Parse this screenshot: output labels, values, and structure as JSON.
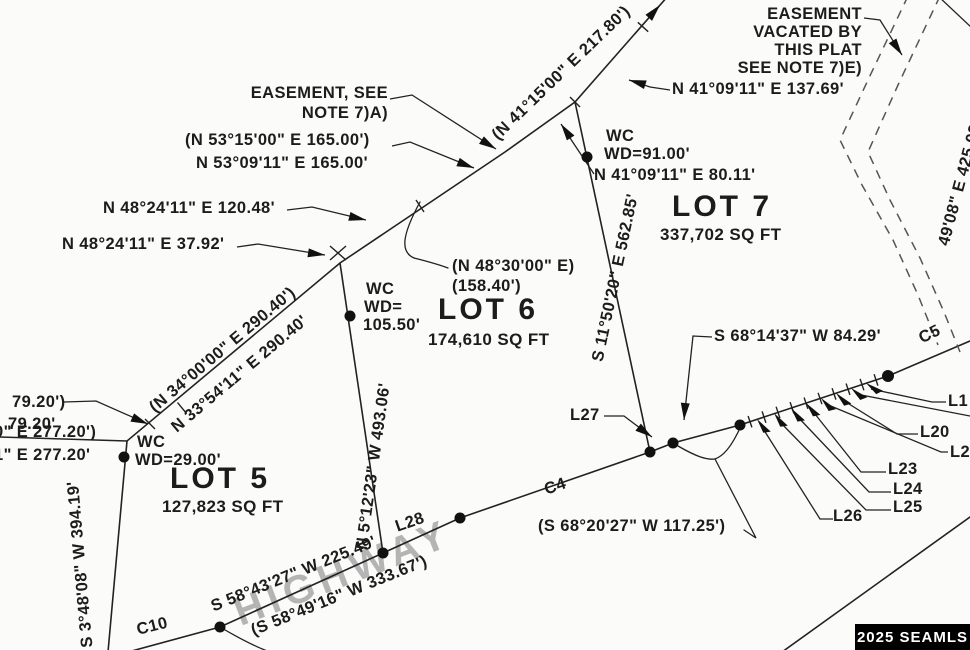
{
  "colors": {
    "ink": "#222222",
    "dash": "#555555",
    "watermark": "#b4b4b4",
    "badge_bg": "#000000",
    "badge_text": "#ffffff"
  },
  "labels": {
    "easement_a_1": "EASEMENT, SEE",
    "easement_a_2": "NOTE 7)A)",
    "easement_e_1": "EASEMENT",
    "easement_e_2": "VACATED BY",
    "easement_e_3": "THIS PLAT",
    "easement_e_4": "SEE NOTE 7)E)",
    "b_n5315": "(N 53°15'00\" E  165.00')",
    "b_n5309": "N 53°09'11\" E  165.00'",
    "b_n4824_120": "N 48°24'11\" E  120.48'",
    "b_n4824_37": "N 48°24'11\" E  37.92'",
    "b_n4115": "(N 41°15'00\" E  217.80')",
    "b_n4109_137": "N 41°09'11\" E  137.69'",
    "b_n4109_80": "N 41°09'11\" E  80.11'",
    "wc1": "WC",
    "wc1_wd": "WD=91.00'",
    "b_n3400": "(N 34°00'00\" E  290.40')",
    "b_n3354": "N 33°54'11\" E  290.40'",
    "b_n4830": "(N 48°30'00\" E)",
    "b_n4830_d": "(158.40')",
    "wc2": "WC",
    "wc2_wd": "WD=",
    "wc2_wd2": "105.50'",
    "lot5": "LOT 5",
    "lot5_area": "127,823 SQ FT",
    "lot6": "LOT 6",
    "lot6_area": "174,610 SQ FT",
    "lot7": "LOT 7",
    "lot7_area": "337,702 SQ FT",
    "b_s1150": "S 11°50'20\" E  562.85'",
    "b_n512": "N 5°12'23\" W  493.06'",
    "b_s348": "S 3°48'08\" W  394.19'",
    "b_s6814": "S 68°14'37\" W  84.29'",
    "b_s6820": "(S 68°20'27\" W  117.25')",
    "b_s5843": "S 58°43'27\" W  225.49'",
    "b_s5849": "(S 58°49'16\" W  333.67')",
    "d_7920a": "79.20')",
    "d_7920b": "79.20'",
    "d_27720a": "0\" E  277.20')",
    "d_27720b": "1\" E  277.20'",
    "wc3": "WC",
    "wc3_wd": "WD=29.00'",
    "b_425": "49'08\" E  425.03'",
    "l27": "L27",
    "l28": "L28",
    "l26": "L26",
    "l25": "L25",
    "l24": "L24",
    "l23": "L23",
    "l20": "L20",
    "l2cut": "L2",
    "l1": "L1",
    "c4": "C4",
    "c5": "C5",
    "c10": "C10",
    "highway": "HIGHWAY",
    "badge": "2025 SEAMLS"
  }
}
